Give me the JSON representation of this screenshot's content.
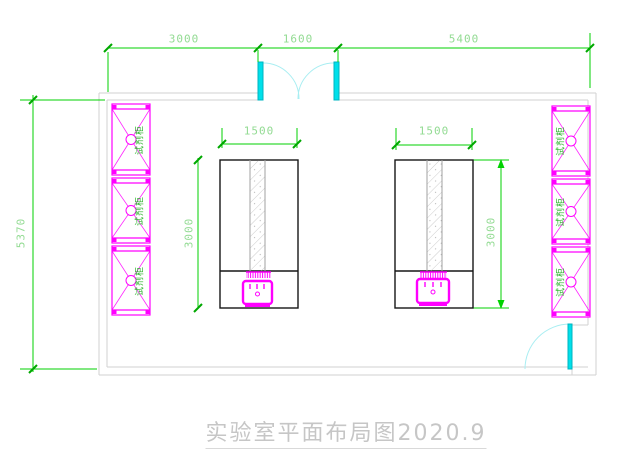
{
  "drawing": {
    "title": "实验室平面布局图2020.9"
  },
  "dimensions": {
    "top": {
      "seg1": "3000",
      "seg2": "1600",
      "seg3": "5400"
    },
    "left": {
      "total": "5370"
    },
    "bench_left": {
      "width": "1500",
      "depth": "3000"
    },
    "bench_right": {
      "width": "1500",
      "depth": "3000"
    }
  },
  "labels": {
    "reagent_cabinet": "试剂柜"
  },
  "colors": {
    "dimension_line": "#00d200",
    "dimension_text": "#93db93",
    "cabinet_magenta": "#ff00ff",
    "door_cyan": "#00e0ea",
    "wall_gray": "#d2d2d2",
    "bench_outline": "#161616",
    "cabinet_label_green": "#29b329",
    "title_gray": "#c6c6c6"
  }
}
